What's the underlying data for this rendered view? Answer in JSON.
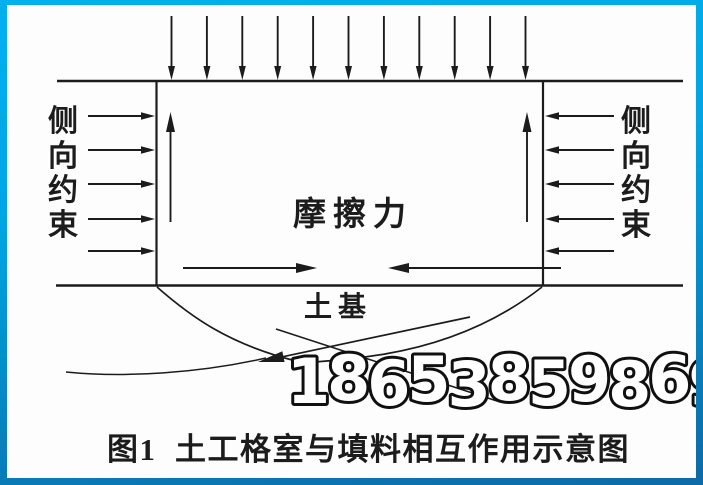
{
  "frame": {
    "border_top_color": "#00b1ee",
    "border_bottom_color": "#0d6aa6",
    "paper_color": "#fdfdfd"
  },
  "diagram": {
    "ink_color": "#1c1c1c",
    "labels": {
      "left_constraint": "侧向约束",
      "right_constraint": "侧向约束",
      "friction": "摩擦力",
      "subgrade": "土基"
    },
    "watermark": "18653859869",
    "caption": "图1  土工格室与填料相互作用示意图"
  }
}
